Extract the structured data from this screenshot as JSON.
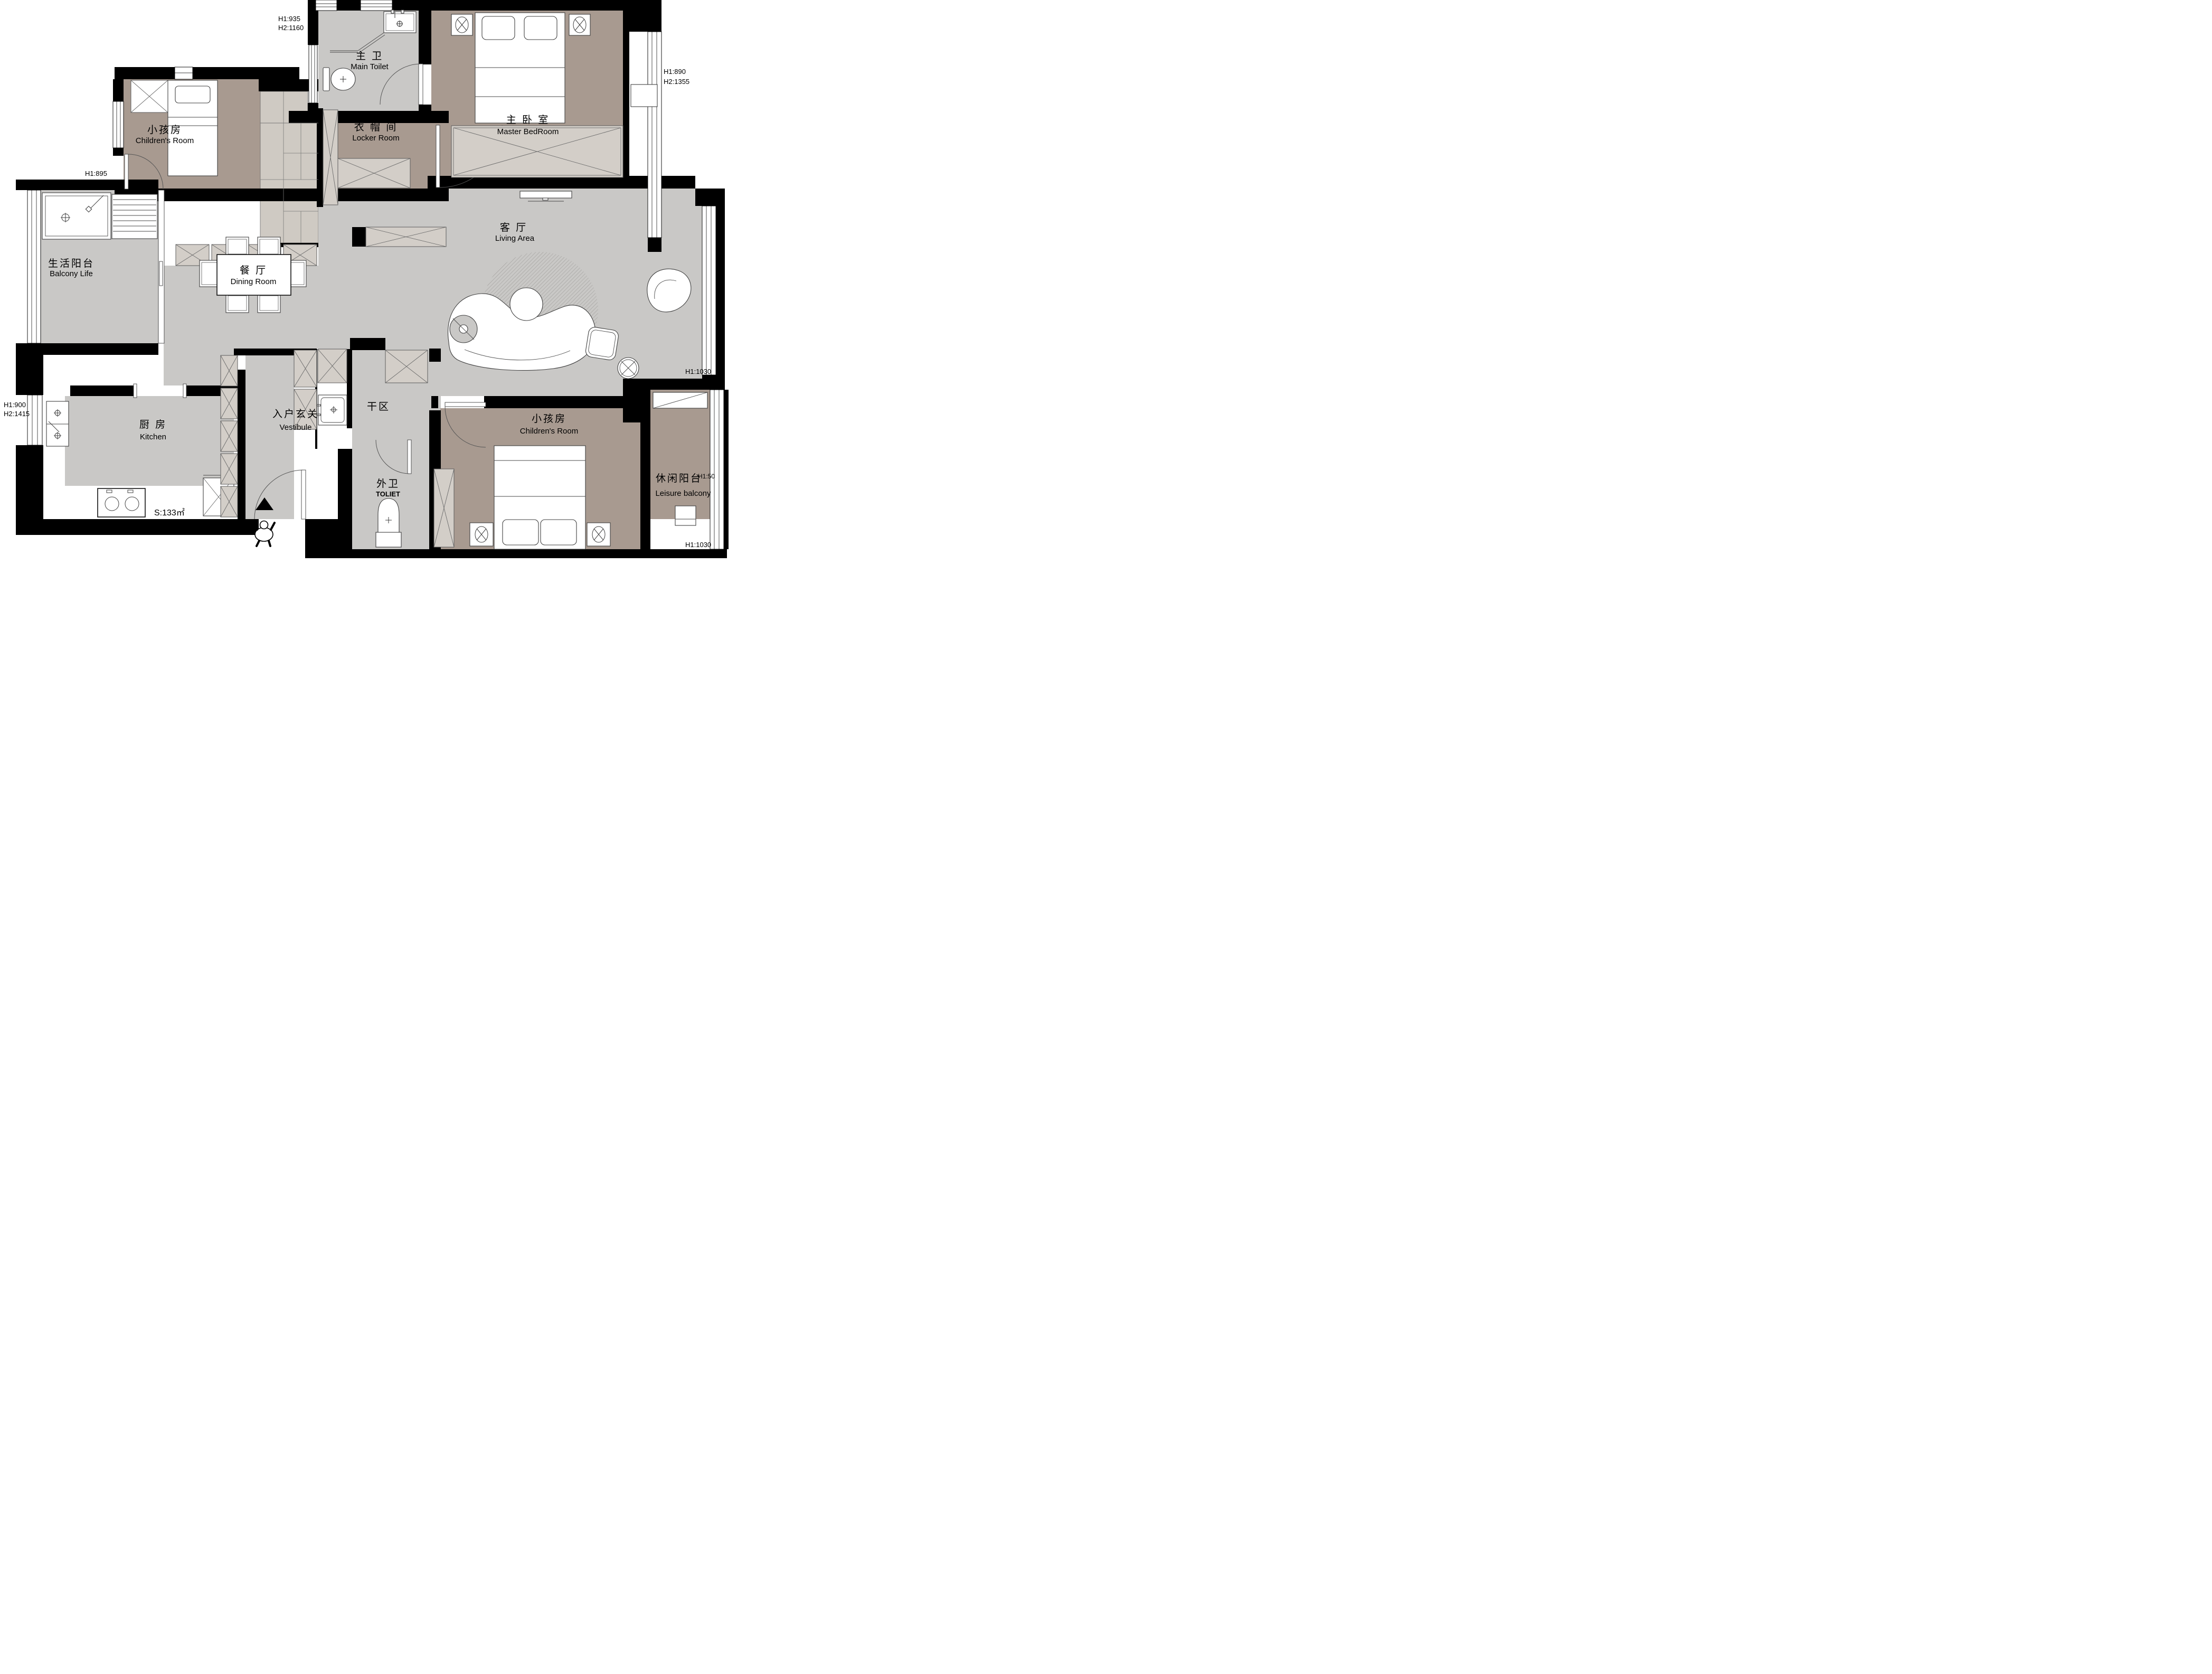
{
  "plan": {
    "main_toilet": {
      "zh": "主 卫",
      "en": "Main Toilet"
    },
    "children_top": {
      "zh": "小孩房",
      "en": "Children's Room"
    },
    "locker": {
      "zh": "衣 帽 间",
      "en": "Locker Room"
    },
    "master": {
      "zh": "主 卧 室",
      "en": "Master BedRoom"
    },
    "living": {
      "zh": "客 厅",
      "en": "Living Area"
    },
    "balcony_life": {
      "zh": "生活阳台",
      "en": "Balcony Life"
    },
    "dining": {
      "zh": "餐 厅",
      "en": "Dining Room"
    },
    "kitchen": {
      "zh": "厨 房",
      "en": "Kitchen"
    },
    "vestibule": {
      "zh": "入户玄关",
      "en": "Vestibule"
    },
    "dry_area": {
      "zh": "干区",
      "en": ""
    },
    "outer_toilet": {
      "zh": "外卫",
      "en": "TOLIET"
    },
    "children_bottom": {
      "zh": "小孩房",
      "en": "Children's Room"
    },
    "leisure_balcony": {
      "zh": "休闲阳台",
      "en": "Leisure balcony"
    }
  },
  "dimensions": {
    "top_left_1": "H1:935",
    "top_left_2": "H2:1160",
    "left_upper_1": "H1:895",
    "left_upper_2": "H2:1390",
    "right_upper_1": "H1:890",
    "right_upper_2": "H2:1355",
    "left_lower_1": "H1:900",
    "left_lower_2": "H2:1415",
    "right_mid": "H1:1030",
    "leisure_h": "H1:50",
    "right_bottom": "H1:1030"
  },
  "annotations": {
    "area": "S:133㎡"
  },
  "colors": {
    "wall": "#000000",
    "floor_gray": "#c9c8c6",
    "floor_taupe": "#a89a90",
    "cabinet_fill": "#d3cec8",
    "closet_fill": "#cfcac3",
    "line": "#4a4a4a"
  }
}
